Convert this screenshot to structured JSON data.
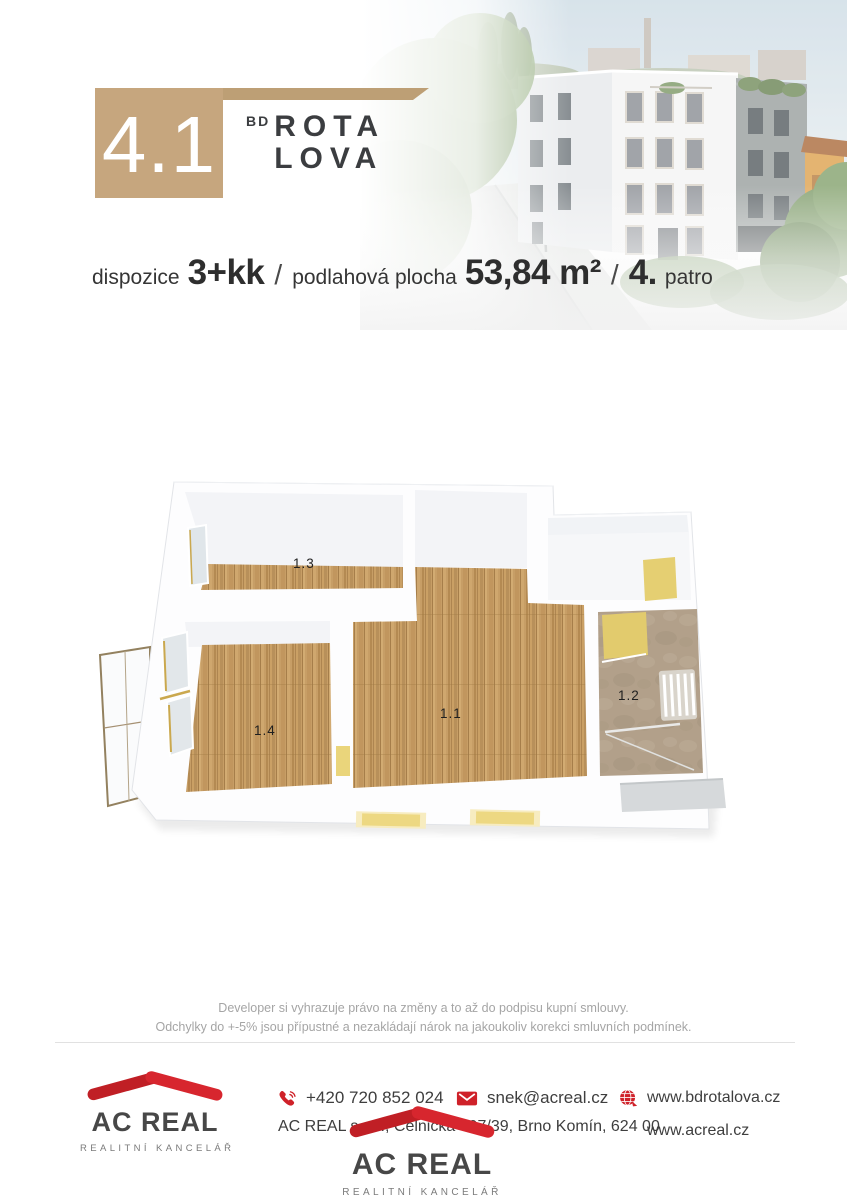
{
  "unit": {
    "number": "4.1"
  },
  "brand": {
    "prefix": "BD",
    "line1": "ROTA",
    "line2": "LOVA"
  },
  "specs": {
    "dispozice_label": "dispozice",
    "dispozice_value": "3+kk",
    "separator": "/",
    "plocha_label": "podlahová plocha",
    "plocha_value": "53,84 m²",
    "patro_value": "4.",
    "patro_label": "patro"
  },
  "floorplan": {
    "rooms": [
      {
        "label": "1.1"
      },
      {
        "label": "1.2"
      },
      {
        "label": "1.3"
      },
      {
        "label": "1.4"
      }
    ]
  },
  "disclaimer": {
    "line1": "Developer si vyhrazuje právo na změny a to až do podpisu kupní smlouvy.",
    "line2": "Odchylky do +-5% jsou přípustné a nezakládají nárok na jakoukoliv korekci smluvních podmínek."
  },
  "footer": {
    "phone": "+420 720 852 024",
    "email": "snek@acreal.cz",
    "address": "AC REAL s.r.o., Celnická 397/39, Brno Komín, 624 00",
    "website_project": "www.bdrotalova.cz",
    "website_agency": "www.acreal.cz",
    "agency_name": "AC REAL",
    "agency_tagline": "REALITNÍ KANCELÁŘ"
  },
  "colors": {
    "tan": "#c6a67e",
    "red": "#cf2129",
    "dark_text": "#3b3d40"
  }
}
